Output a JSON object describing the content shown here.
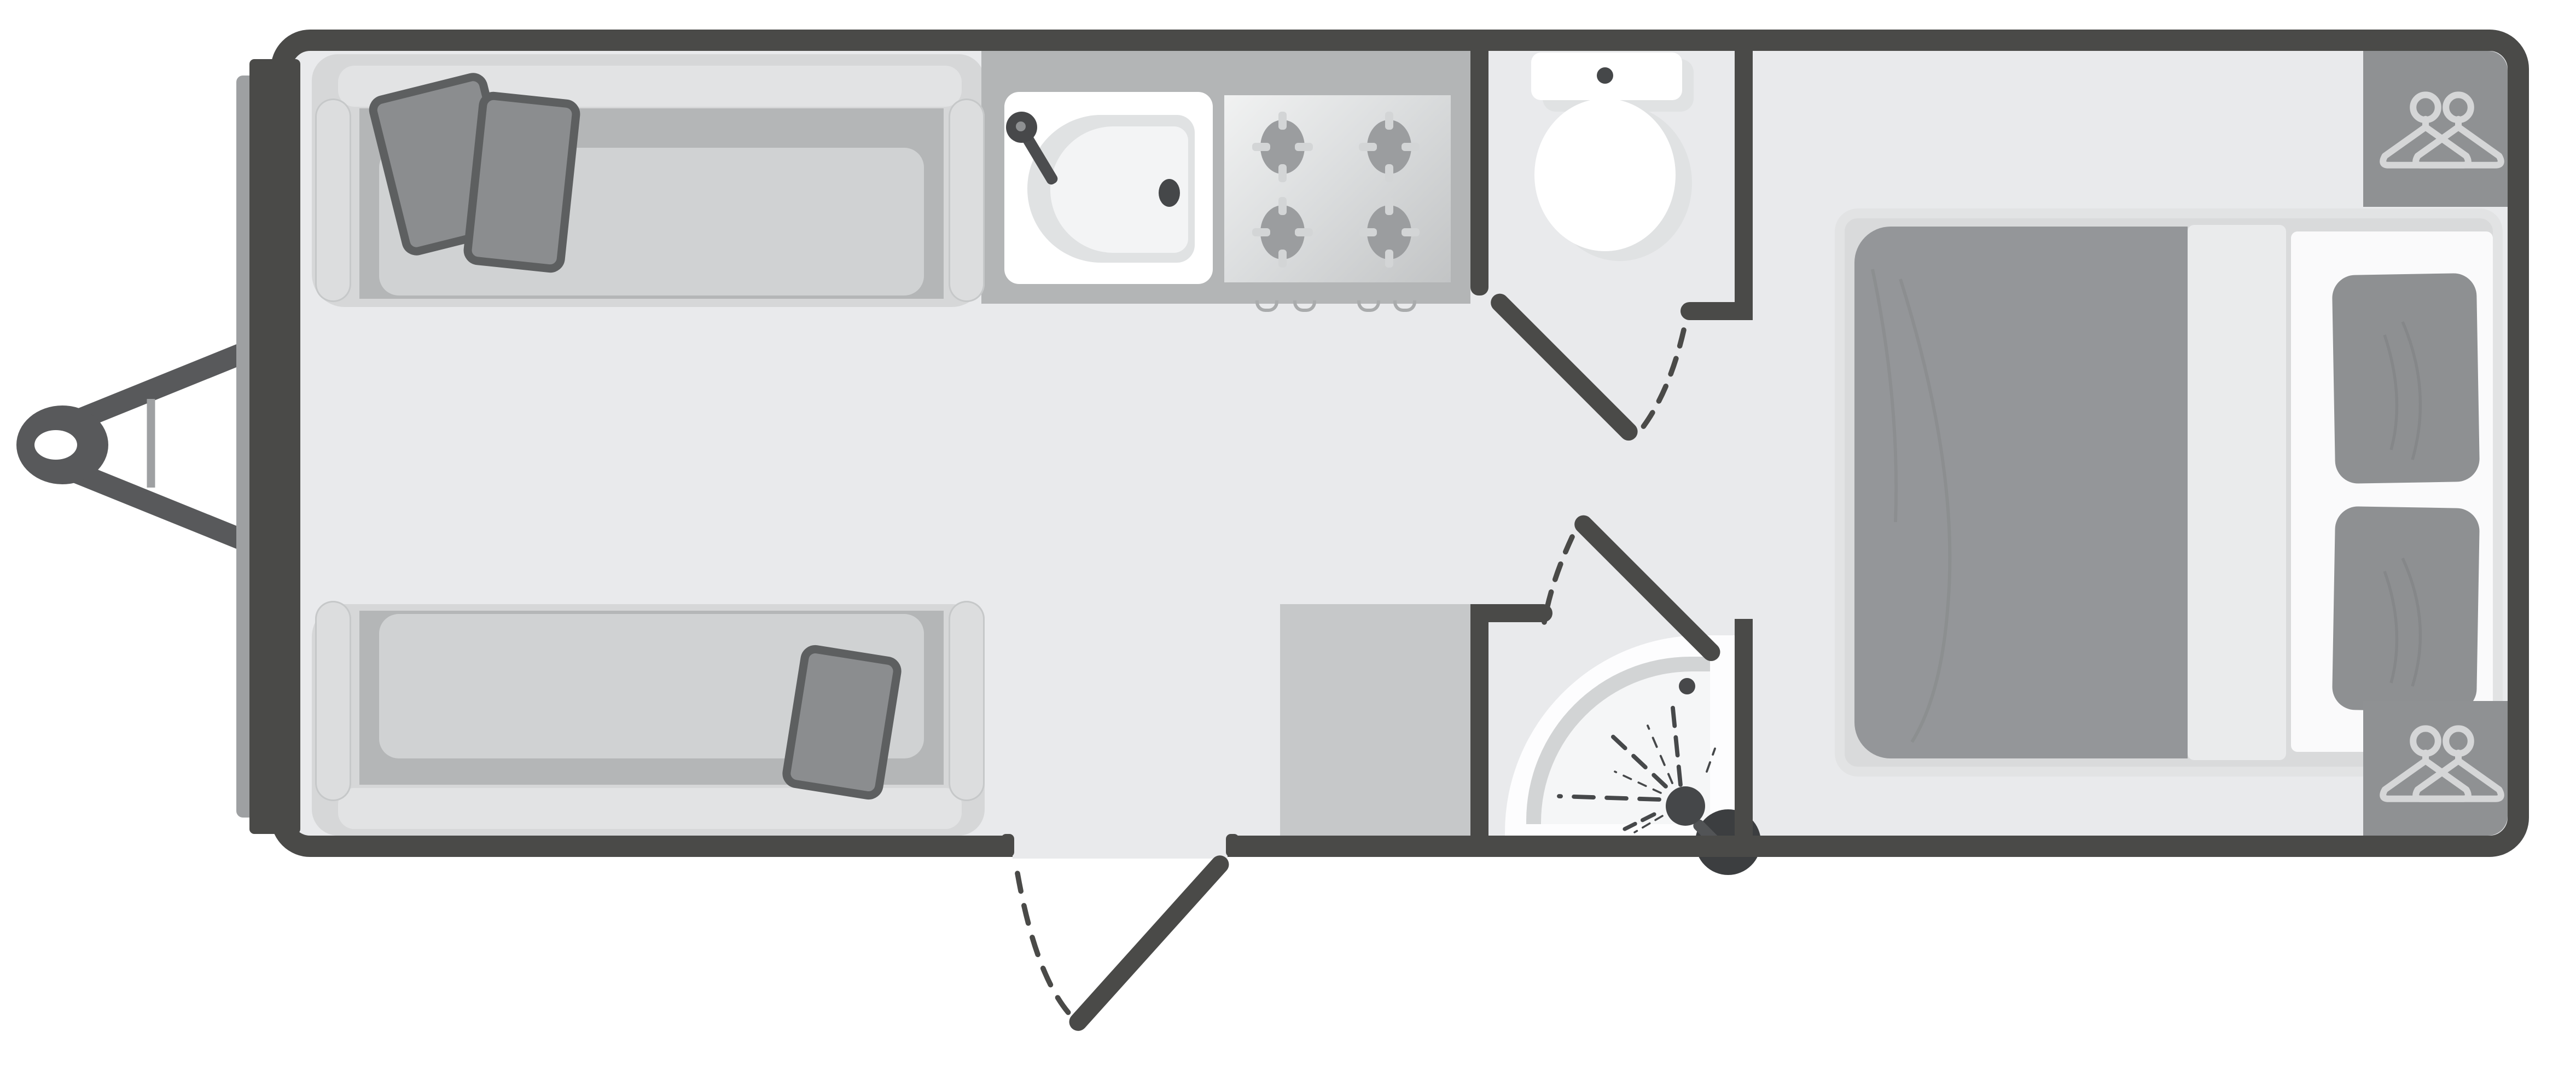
{
  "diagram": {
    "type": "floorplan",
    "subject": "single-axle touring caravan, top-down plan view",
    "orientation": "tow hitch on the left, bedroom on the right",
    "visible_text": "none"
  },
  "labels": {
    "floorplan": "Caravan floor plan",
    "hitch": "A-frame tow hitch with coupling ring",
    "jockey_wheel": "jockey wheel bar",
    "bumper": "front trim rail",
    "lounge": "Front lounge with two parallel sofas",
    "sofa_front": "Lounge sofa (top, nearside)",
    "sofa_rear": "Lounge sofa (bottom, offside)",
    "scatter_cushions": "Scatter cushions",
    "kitchen": "Kitchen galley",
    "sink": "Kitchen sink with mixer tap",
    "hob": "Four-burner gas hob",
    "drawers": "Under-counter drawer handles",
    "entry_door": "Entry door (opens outward)",
    "washroom": "Washroom with toilet",
    "toilet": "Toilet with cistern",
    "washroom_door": "Washroom door (opens inward)",
    "shower_room": "Shower cubicle room",
    "shower": "Quadrant shower tray with shower head",
    "shower_door": "Shower room door (opens inward)",
    "cabinet": "Kitchen cabinet / appliance block",
    "bedroom": "Rear bedroom",
    "bed": "Transverse double bed",
    "duvet": "Duvet",
    "sheet_fold": "Folded sheet runner",
    "pillows": "Two pillows",
    "wardrobe_top": "Wardrobe (top corner) with hanger symbol",
    "wardrobe_bottom": "Wardrobe (bottom corner) with hanger symbol"
  },
  "counts": {
    "hob_burners": 4,
    "drawer_handles": 4,
    "lounge_scatter_cushions": 3,
    "bed_pillows": 2,
    "wardrobes": 2,
    "interior_doors": 2,
    "entry_doors": 1,
    "sofas": 2
  },
  "icons": [
    "hanger-icon",
    "shower-spray-icon",
    "burner-icon",
    "faucet-icon",
    "drain-icon",
    "flush-button-icon"
  ],
  "colors": {
    "wall": "#4a4a48",
    "floor": "#e9eaec",
    "exterior": "#ffffff",
    "fixture_white": "#ffffff",
    "fixture_shadow": "#e0e2e3",
    "counter": "#b3b5b6",
    "hob_light": "#f1f2f2",
    "hob_dark": "#c2c4c5",
    "burner": "#9b9d9f",
    "burner_tick": "#d3d5d6",
    "sofa_body": "#d6d7d8",
    "sofa_backrest": "#e2e3e4",
    "seat_base": "#b4b6b7",
    "seat_cushion": "#d0d2d3",
    "armrest": "#dcddde",
    "cushion_dark": "#8b8d8f",
    "cushion_edge": "#5d5f60",
    "cabinet": "#c6c8c9",
    "wardrobe": "#8f9193",
    "hanger": "#d5d6d7",
    "duvet": "#949699",
    "duvet_crease": "#8a8c8e",
    "mattress": "#d9dadb",
    "mattress_edge": "#e2e3e4",
    "sheet": "#eaebec",
    "pillow_panel": "#fafafb",
    "pillow": "#8e9092",
    "shower_tray_band": "#d2d4d5",
    "shower_tray_inner": "#f5f6f7",
    "shower_head": "#454749",
    "bumper": "#9ea0a2",
    "hitch": "#58595b"
  }
}
